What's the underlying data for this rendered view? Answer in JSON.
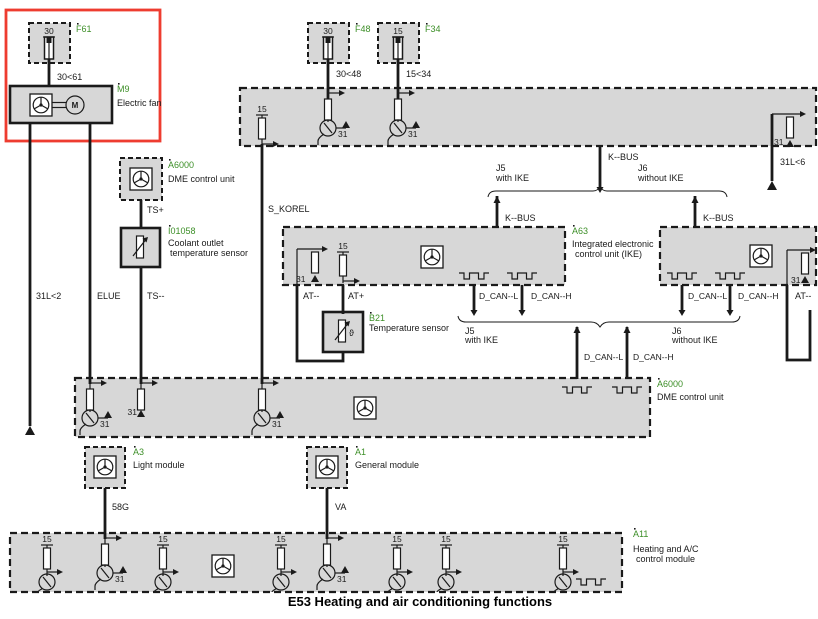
{
  "title": "E53 Heating and air conditioning functions",
  "pins": {
    "p30": "30",
    "p15": "15",
    "p31": "31"
  },
  "wires": {
    "w3061": "30<61",
    "w3048": "30<48",
    "w1534": "15<34",
    "w31l2": "31L<2",
    "w31l6": "31L<6",
    "elue": "ELUE",
    "ts_plus": "TS+",
    "ts_minus": "TS--",
    "s_korel": "S_KOREL",
    "kbus": "K--BUS",
    "dcan_l": "D_CAN--L",
    "dcan_h": "D_CAN--H",
    "at_minus": "AT--",
    "at_plus": "AT+",
    "w58g": "58G",
    "va": "VA"
  },
  "junctions": {
    "j5": "J5",
    "j5_desc": "with IKE",
    "j6": "J6",
    "j6_desc": "without IKE"
  },
  "components": {
    "f61": {
      "id": "F61"
    },
    "f48": {
      "id": "F48"
    },
    "f34": {
      "id": "F34"
    },
    "m9": {
      "id": "M9",
      "name": "Electric fan",
      "motor_letter": "M"
    },
    "dme_top": {
      "id": "A6000",
      "name": "DME control unit"
    },
    "coolant_sensor": {
      "id": "I01058",
      "name1": "Coolant outlet",
      "name2": "temperature sensor"
    },
    "temp_sensor": {
      "id": "B21",
      "name": "Temperature sensor",
      "theta": "ϑ"
    },
    "ike": {
      "id": "A63",
      "name1": "Integrated electronic",
      "name2": "control unit (IKE)"
    },
    "dme_bottom": {
      "id": "A6000",
      "name": "DME control unit"
    },
    "light_module": {
      "id": "A3",
      "name": "Light module"
    },
    "general_module": {
      "id": "A1",
      "name": "General module"
    },
    "hvac": {
      "id": "A11",
      "name1": "Heating and A/C",
      "name2": "control module"
    }
  },
  "colors": {
    "highlight": "#ee3c30",
    "label_green": "#3d8f28",
    "box_fill": "#d7d7d7"
  }
}
